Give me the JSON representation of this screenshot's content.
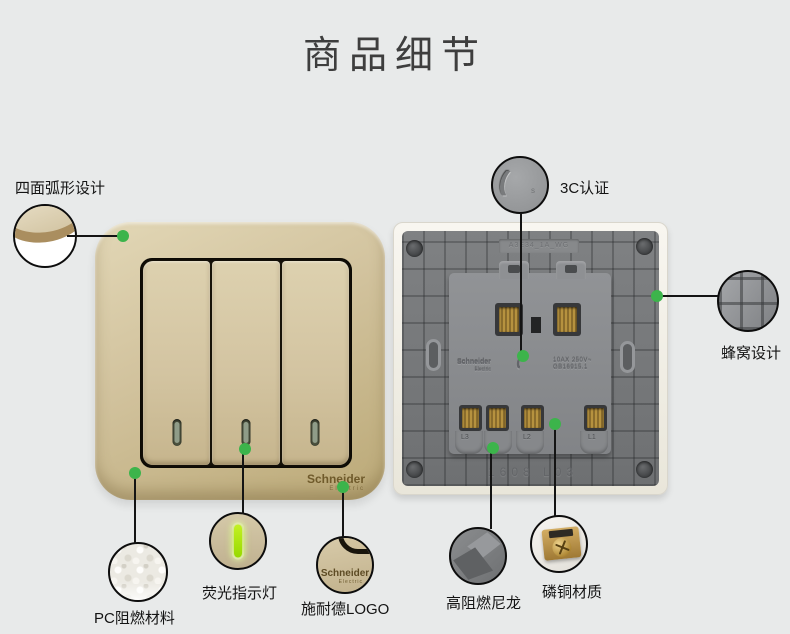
{
  "page": {
    "title": "商品细节"
  },
  "callouts": [
    {
      "label": "四面弧形设计"
    },
    {
      "label": "3C认证"
    },
    {
      "label": "蜂窝设计"
    },
    {
      "label": "PC阻燃材料"
    },
    {
      "label": "荧光指示灯"
    },
    {
      "label": "施耐德LOGO"
    },
    {
      "label": "高阻燃尼龙"
    },
    {
      "label": "磷铜材质"
    }
  ],
  "front_panel": {
    "brand": "Schneider",
    "brand_sub": "Electric"
  },
  "back_panel": {
    "model_emboss": "A3E34_1A_WG",
    "brand_emboss": "Schneider",
    "brand_emboss_sub": "Electric",
    "spec_emboss_line1": "10AX 250V~",
    "spec_emboss_line2": "GB16915.1",
    "batch_emboss": "1608  L03",
    "terminal_labels": [
      "L3",
      "L2",
      "L1"
    ]
  },
  "icons": {
    "ccc_arcs": "(((",
    "ccc_s": "s"
  },
  "colors": {
    "background": "#e8eaea",
    "accent_green": "#3cb44b",
    "panel_gold": "#cdbd97",
    "back_gray": "#7b7d7f",
    "indicator_green": "#a8e61e"
  }
}
